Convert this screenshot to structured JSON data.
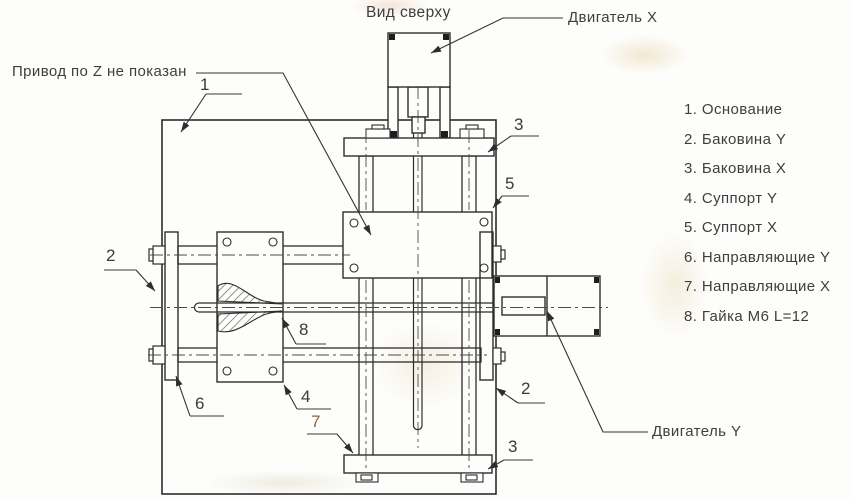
{
  "labels": {
    "view_title": "Вид сверху",
    "motor_x": "Двигатель X",
    "motor_y": "Двигатель Y",
    "z_note": "Привод по Z не показан"
  },
  "parts_list": {
    "items": [
      "1. Основание",
      "2. Баковина Y",
      "3. Баковина X",
      "4. Суппорт Y",
      "5. Суппорт X",
      "6. Направляющие Y",
      "7. Направляющие X",
      "8. Гайка М6 L=12"
    ]
  },
  "callouts": {
    "base": "1",
    "side_y_left": "2",
    "side_y_right": "2",
    "side_x_top": "3",
    "side_x_bottom": "3",
    "support_y": "4",
    "support_x": "5",
    "guides_y": "6",
    "guides_x": "7",
    "nut_m6": "8"
  },
  "colors": {
    "line": "#2d2d2d",
    "paper": "#fdfdfb",
    "text": "#3e3e3e",
    "rust_accent": "#96603c"
  }
}
